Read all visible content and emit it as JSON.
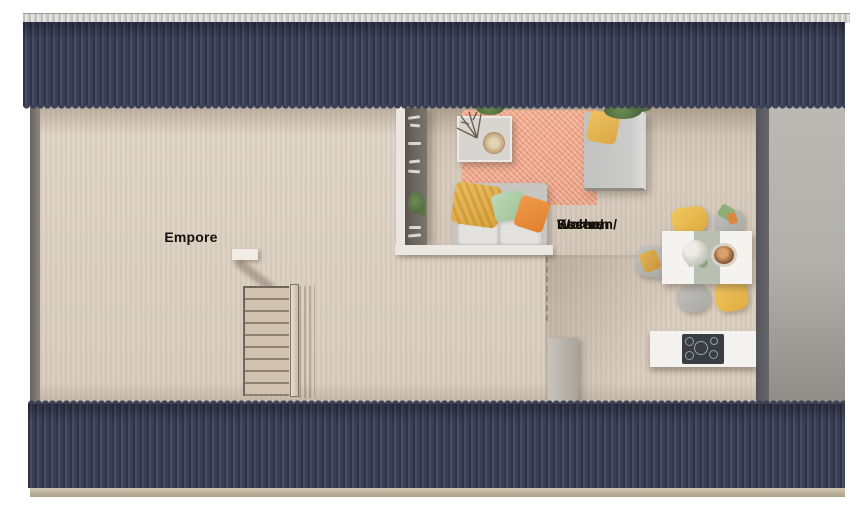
{
  "labels": {
    "empore": "Empore",
    "living_kitchen": {
      "line1": "Wohnen/",
      "line2": "Essen/",
      "line3": "Kochen"
    }
  },
  "colors": {
    "roof_metal": "#3d4157",
    "roof_stripe_dark": "#30344a",
    "roof_stripe_light": "#494d63",
    "ridge_cap": "#d8d7d4",
    "eave_tan": "#c2b8a2",
    "floor_wood": "#dcd1c4",
    "wall_white": "#ebe7e0",
    "wall_dark_gray": "#5b5d62",
    "wall_light_gray": "#b3b0ab",
    "rug_salmon": "#eda186",
    "sofa_gray": "#c7c6c2",
    "accent_yellow": "#e8b94f",
    "accent_green": "#aecfaa",
    "accent_orange": "#ec8c3b",
    "surface_white": "#f3f2ef",
    "cooktop_black": "#3a3d42",
    "stair_wood": "#d2c3b0"
  },
  "furniture": [
    "staircase",
    "stair-railing",
    "bookshelf",
    "sofa",
    "rug",
    "coffee-table",
    "daybed",
    "plants",
    "dining-table",
    "dining-chairs",
    "kitchen-island",
    "cooktop"
  ]
}
